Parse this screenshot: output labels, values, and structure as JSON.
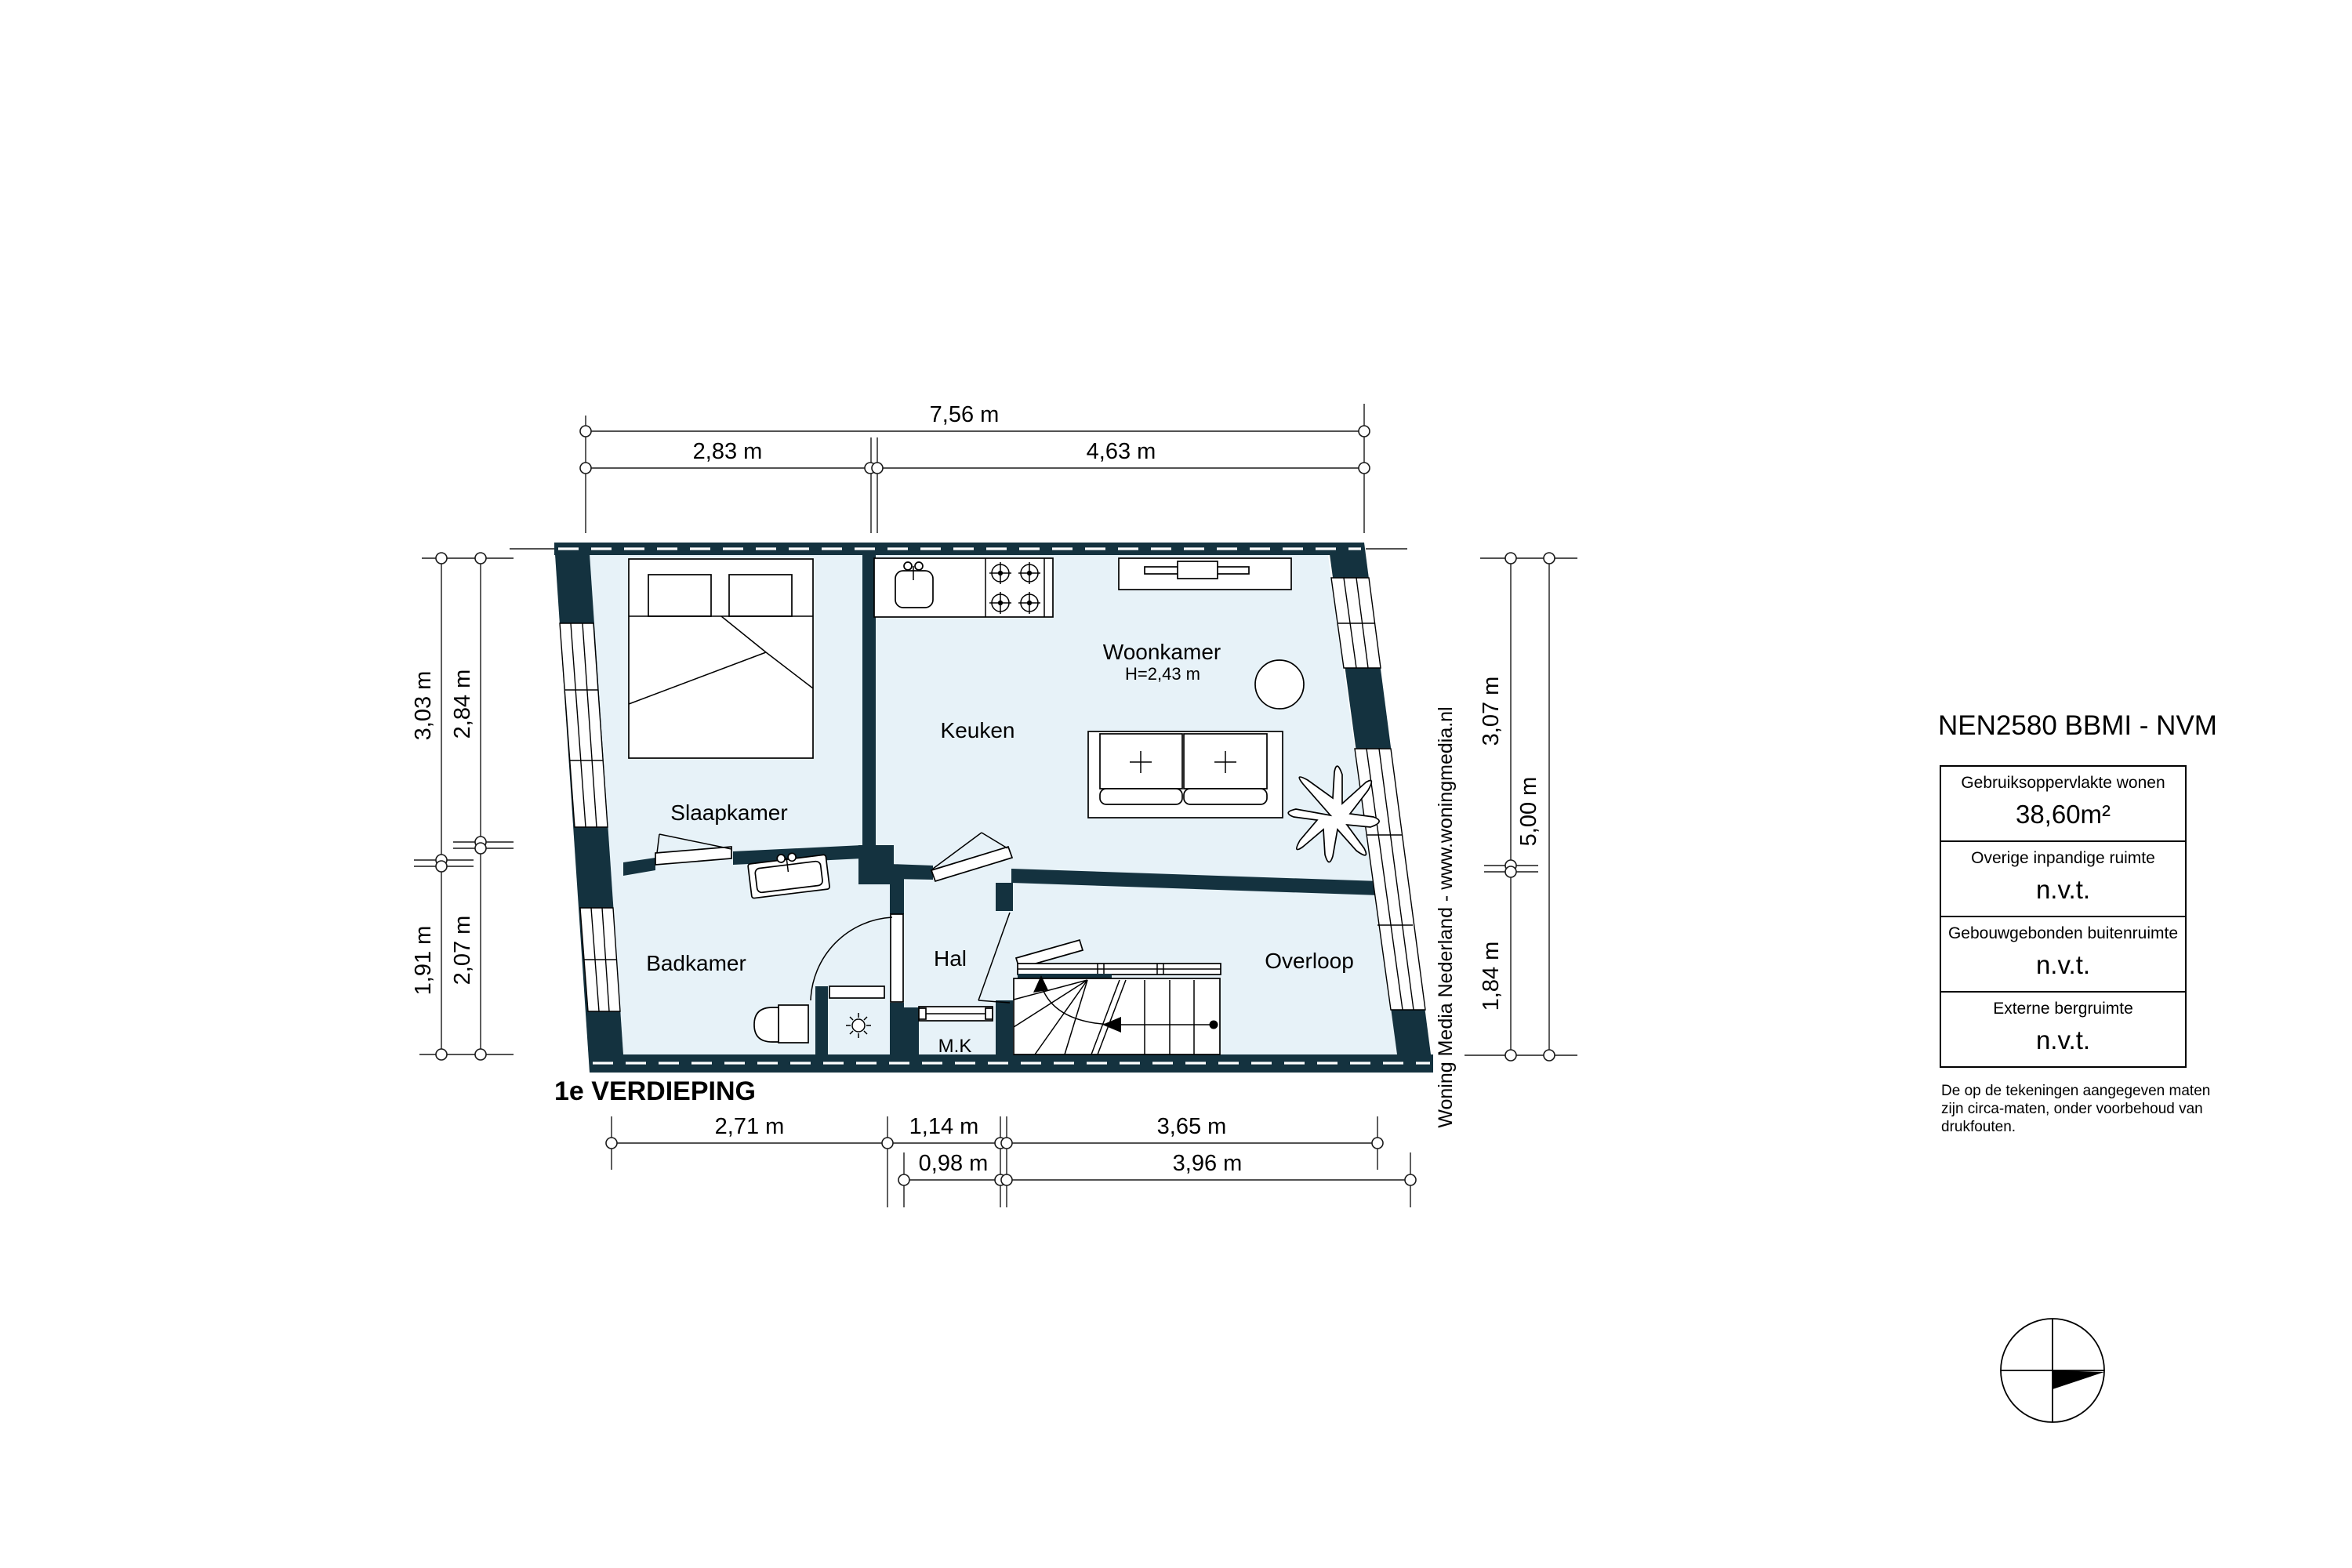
{
  "plan": {
    "title": "1e VERDIEPING",
    "watermark": "Woning Media Nederland - www.woningmedia.nl",
    "rooms": {
      "slaapkamer": "Slaapkamer",
      "keuken": "Keuken",
      "woonkamer": "Woonkamer",
      "woonkamer_height": "H=2,43 m",
      "badkamer": "Badkamer",
      "hal": "Hal",
      "mk": "M.K",
      "overloop": "Overloop"
    },
    "dims": {
      "total_width": "7,56 m",
      "top_left": "2,83 m",
      "top_right": "4,63 m",
      "left_outer_top": "3,03 m",
      "left_outer_bottom": "1,91 m",
      "left_inner_top": "2,84 m",
      "left_inner_bottom": "2,07 m",
      "right_inner_top": "3,07 m",
      "right_inner_bottom": "1,84 m",
      "right_outer": "5,00 m",
      "bottom_row1_left": "2,71 m",
      "bottom_row1_mid": "1,14 m",
      "bottom_row1_right": "3,65 m",
      "bottom_row2_left": "0,98 m",
      "bottom_row2_right": "3,96 m"
    },
    "colors": {
      "wall": "#14323f",
      "floor": "#e7f2f8"
    }
  },
  "legend": {
    "title": "NEN2580 BBMI - NVM",
    "rows": [
      {
        "label": "Gebruiksoppervlakte wonen",
        "value": "38,60m²"
      },
      {
        "label": "Overige inpandige ruimte",
        "value": "n.v.t."
      },
      {
        "label": "Gebouwgebonden buitenruimte",
        "value": "n.v.t."
      },
      {
        "label": "Externe bergruimte",
        "value": "n.v.t."
      }
    ],
    "disclaimer": "De op de tekeningen aangegeven maten zijn circa-maten, onder voorbehoud van drukfouten."
  }
}
